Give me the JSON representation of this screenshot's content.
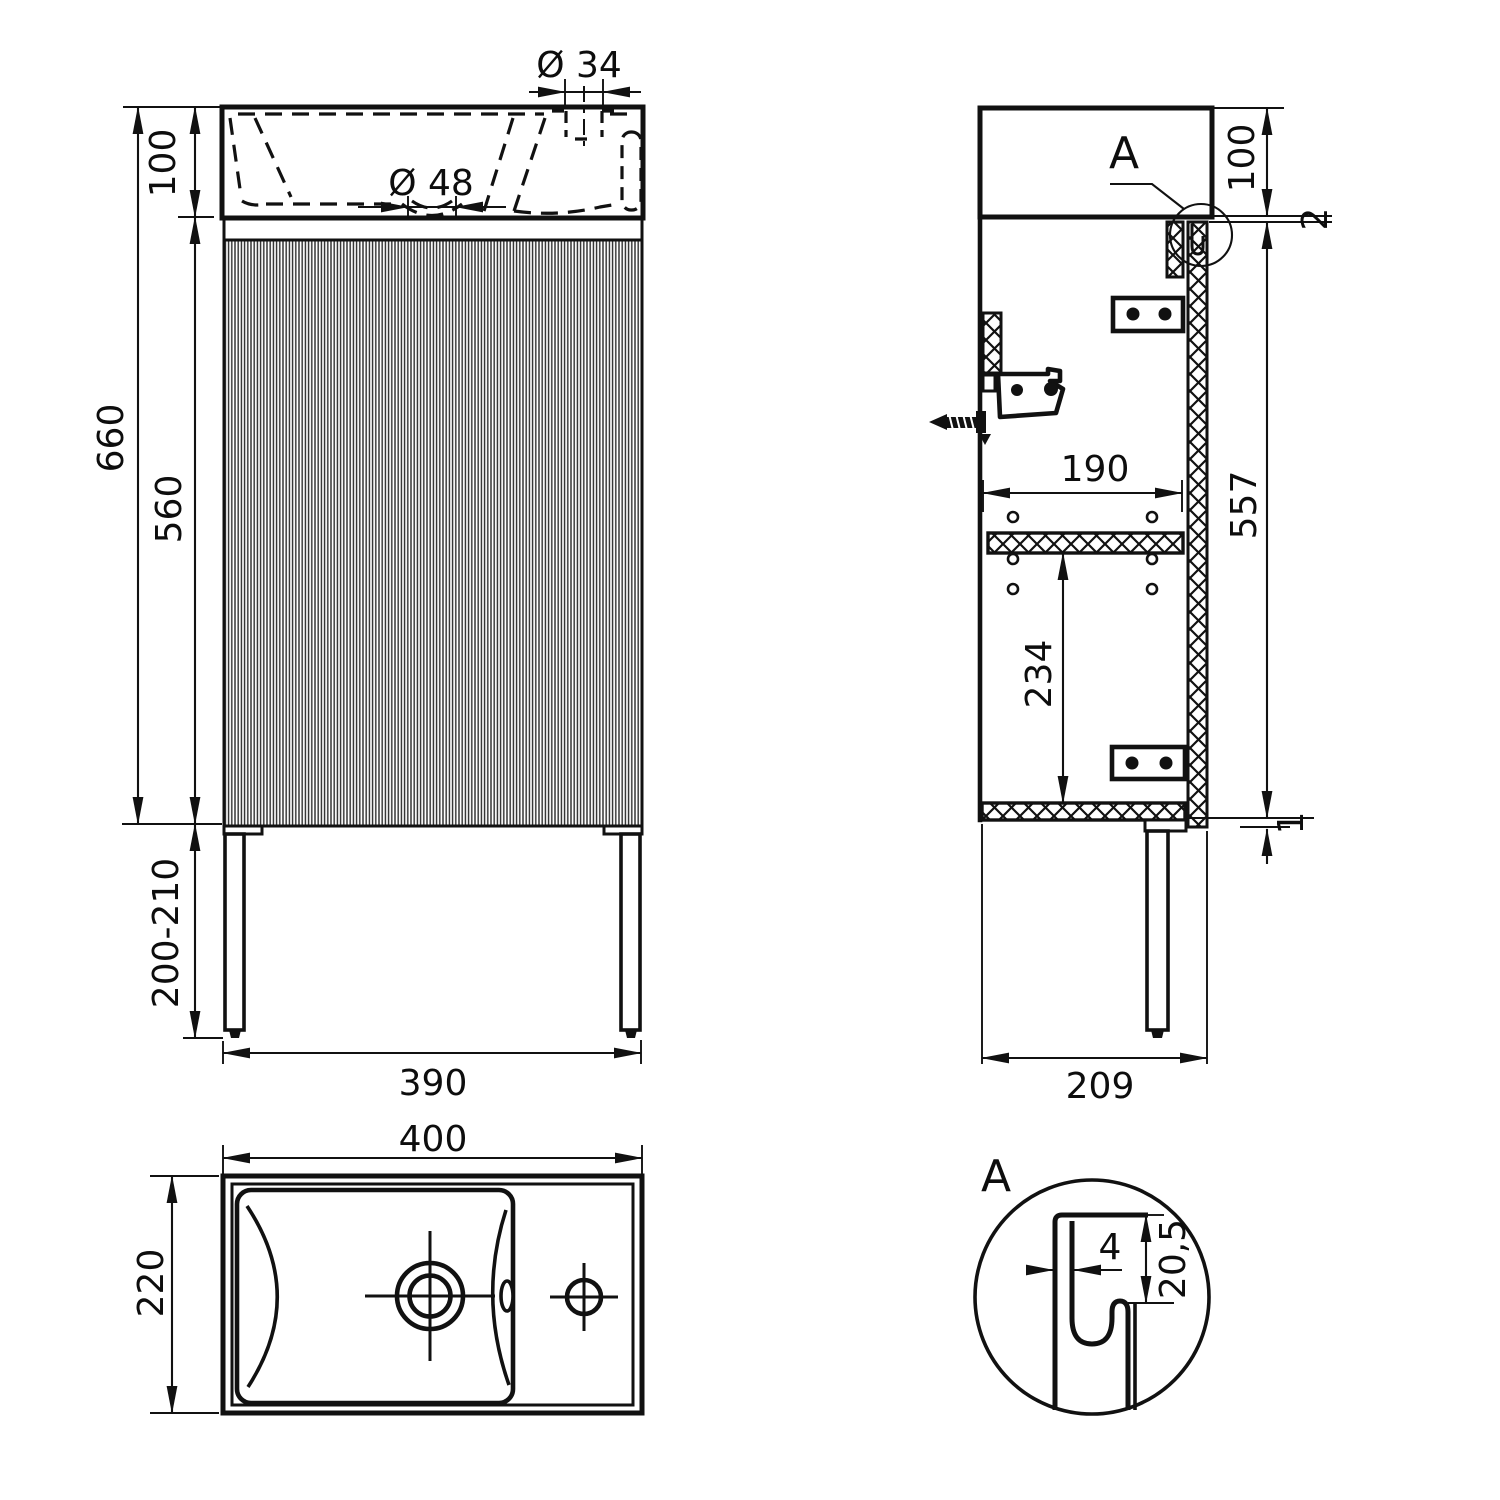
{
  "drawing": {
    "type": "technical-orthographic-drawing",
    "subject": "bathroom vanity cabinet with washbasin",
    "line_color": "#111111",
    "background": "#ffffff",
    "labels": {
      "front_faucet_dia": "Ø 34",
      "front_drain_dia": "Ø 48",
      "front_sink_height": "100",
      "front_total_height": "660",
      "front_body_height": "560",
      "front_leg_height": "200-210",
      "front_width": "390",
      "side_detail_marker": "A",
      "side_sink_height": "100",
      "side_top_gap": "2",
      "side_inner_depth": "190",
      "side_body_height": "557",
      "side_shelf_height": "234",
      "side_bottom_gap": "1",
      "side_depth": "209",
      "top_width": "400",
      "top_depth": "220",
      "detail_marker": "A",
      "detail_wall_thickness": "4",
      "detail_recess_depth": "20,5"
    }
  }
}
